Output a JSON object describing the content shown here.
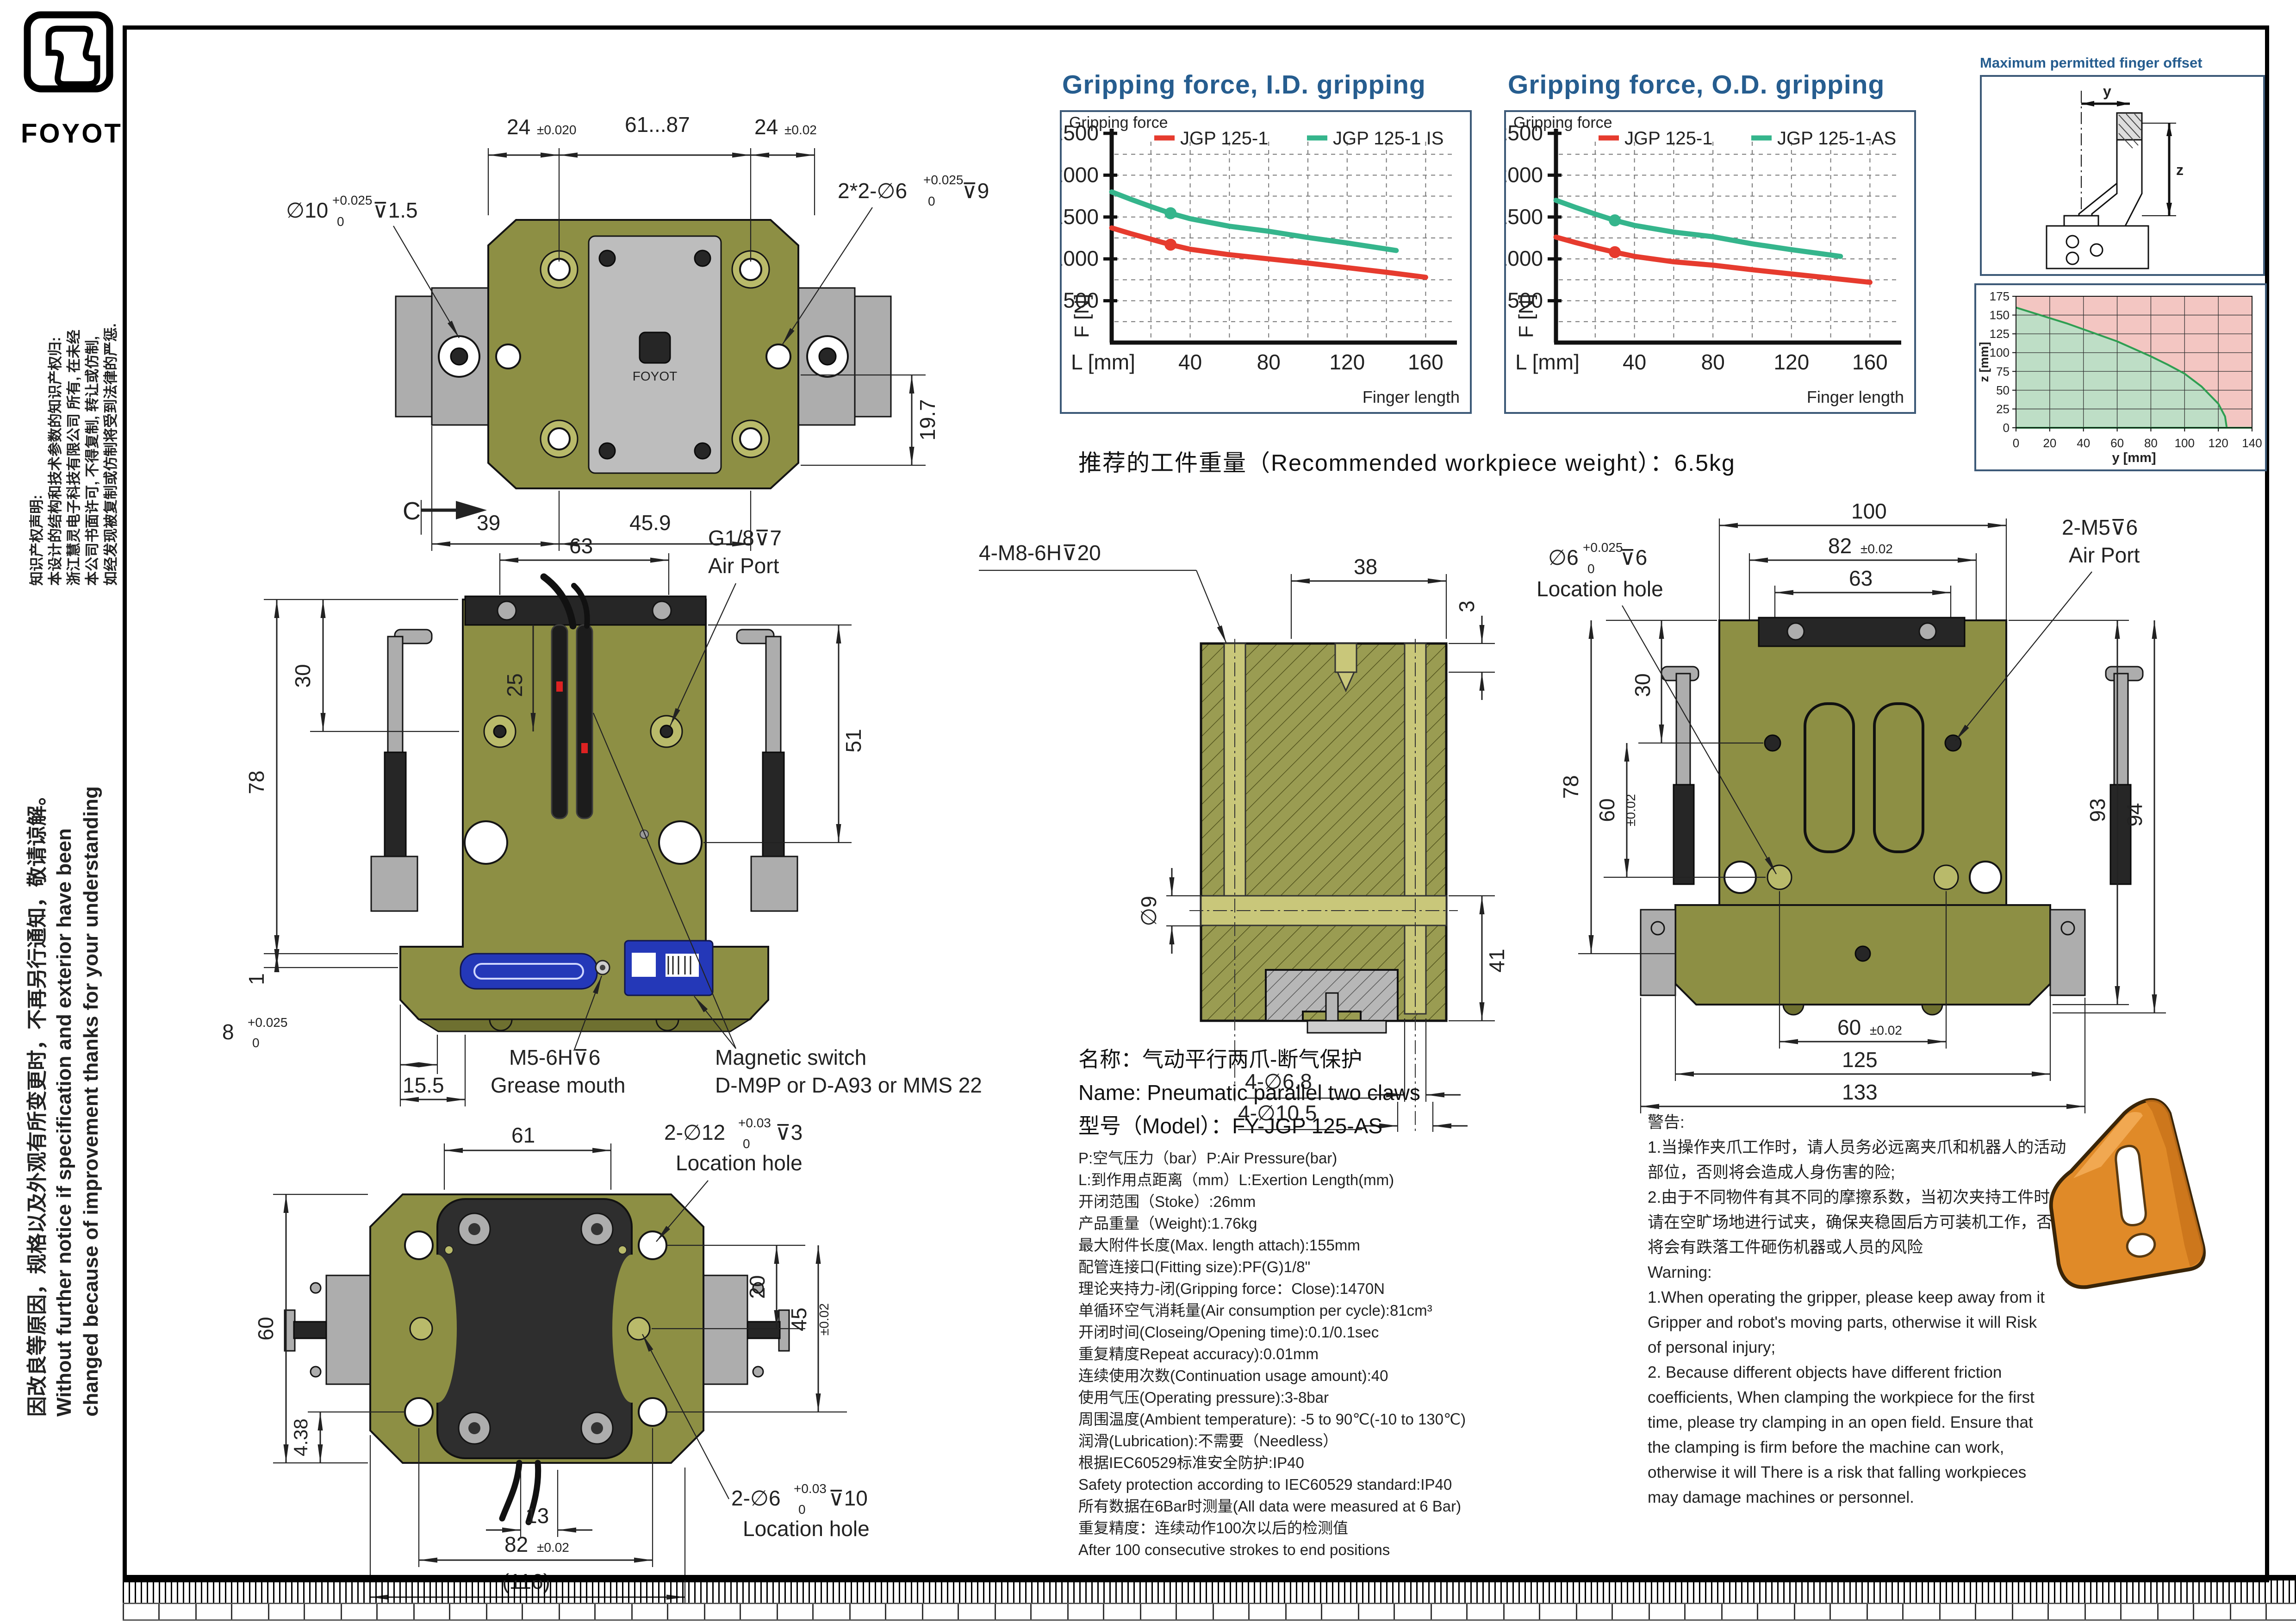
{
  "brand": {
    "name": "FOYOT"
  },
  "left_margin": {
    "ip_lines": [
      "知识产权声明:",
      "本设计的结构和技术参数的知识产权归:",
      "浙江慧灵电子科技有限公司 所有, 在未经",
      "本公司书面许可, 不得复制, 转让或仿制,",
      "如经发现被复制或仿制将受到法律的严惩."
    ],
    "change_lines": [
      "因改良等原因，规格以及外观有所变更时，不再另行通知，敬请谅解。",
      "Without further  notice if specification and exterior have been",
      "changed because of improvement thanks for your understanding"
    ]
  },
  "headings": {
    "id_chart": "Gripping force, I.D. gripping",
    "od_chart": "Gripping force, O.D. gripping",
    "offset": "Maximum permitted finger offset",
    "recommended": "推荐的工件重量（Recommended workpiece weight）：6.5kg"
  },
  "chart_labels": {
    "gripping_force": "Gripping force",
    "f_axis": "F [N]",
    "l_axis": "L [mm]",
    "finger_length": "Finger length",
    "offset_y": "y",
    "offset_z": "z"
  },
  "chart_data": [
    {
      "type": "line",
      "title": "Gripping force, I.D. gripping",
      "xlabel": "L [mm]",
      "ylabel": "F [N]",
      "corner_label": "Finger length",
      "xlim": [
        0,
        175
      ],
      "ylim": [
        0,
        2500
      ],
      "xticks": [
        40,
        80,
        120,
        160
      ],
      "yticks": [
        500,
        1000,
        1500,
        2000,
        2500
      ],
      "xgrid_step": 20,
      "ygrid_step": 250,
      "grid": "dashed",
      "legend_position": "top",
      "series": [
        {
          "name": "JGP 125-1",
          "color": "#e63b2e",
          "x": [
            0,
            10,
            20,
            30,
            40,
            60,
            80,
            100,
            120,
            140,
            160
          ],
          "y": [
            1370,
            1300,
            1235,
            1170,
            1115,
            1050,
            1000,
            950,
            895,
            840,
            780
          ],
          "marker_at": [
            30,
            1170
          ]
        },
        {
          "name": "JGP 125-1 IS",
          "color": "#35b58c",
          "x": [
            0,
            10,
            20,
            30,
            40,
            60,
            80,
            100,
            120,
            145
          ],
          "y": [
            1800,
            1710,
            1625,
            1545,
            1480,
            1390,
            1330,
            1255,
            1190,
            1100
          ],
          "marker_at": [
            30,
            1545
          ]
        }
      ]
    },
    {
      "type": "line",
      "title": "Gripping force, O.D. gripping",
      "xlabel": "L [mm]",
      "ylabel": "F [N]",
      "corner_label": "Finger length",
      "xlim": [
        0,
        175
      ],
      "ylim": [
        0,
        2500
      ],
      "xticks": [
        40,
        80,
        120,
        160
      ],
      "yticks": [
        500,
        1000,
        1500,
        2000,
        2500
      ],
      "xgrid_step": 20,
      "ygrid_step": 250,
      "grid": "dashed",
      "legend_position": "top",
      "series": [
        {
          "name": "JGP 125-1",
          "color": "#e63b2e",
          "x": [
            0,
            10,
            20,
            30,
            40,
            60,
            80,
            100,
            120,
            140,
            160
          ],
          "y": [
            1260,
            1195,
            1135,
            1080,
            1030,
            965,
            925,
            870,
            820,
            770,
            720
          ],
          "marker_at": [
            30,
            1080
          ]
        },
        {
          "name": "JGP 125-1-AS",
          "color": "#35b58c",
          "x": [
            0,
            10,
            20,
            30,
            40,
            60,
            80,
            100,
            120,
            145
          ],
          "y": [
            1700,
            1615,
            1535,
            1460,
            1400,
            1320,
            1265,
            1180,
            1110,
            1030
          ],
          "marker_at": [
            30,
            1460
          ]
        }
      ]
    },
    {
      "type": "area",
      "title": "Maximum permitted finger offset",
      "xlabel": "y [mm]",
      "ylabel": "z [mm]",
      "xlim": [
        0,
        140
      ],
      "ylim": [
        0,
        175
      ],
      "xticks": [
        0,
        20,
        40,
        60,
        80,
        100,
        120,
        140
      ],
      "yticks": [
        0,
        25,
        50,
        75,
        100,
        125,
        150,
        175
      ],
      "grid": "solid",
      "boundary_x": [
        0,
        10,
        20,
        30,
        40,
        50,
        60,
        70,
        80,
        90,
        100,
        110,
        120,
        124,
        125
      ],
      "boundary_y": [
        160,
        153,
        146,
        139,
        131,
        123,
        115,
        105,
        95,
        84,
        72,
        55,
        32,
        15,
        0
      ],
      "safe_color": "#bedec6",
      "unsafe_color": "#f3c6c2",
      "line_color": "#2f9e52"
    }
  ],
  "views": {
    "top": {
      "d24l": "24",
      "t24l": "±0.020",
      "d6187": "61...87",
      "d24r": "24",
      "t24r": "±0.02",
      "holeL": "∅10",
      "holeLt": "+0.025",
      "holeLb": "0",
      "holeLs": "⊽1.5",
      "holeR": "2*2-∅6",
      "holeRt": "+0.025",
      "holeRb": "0",
      "holeRs": "⊽9",
      "d197": "19.7",
      "d39": "39",
      "d459": "45.9"
    },
    "front": {
      "c": "C",
      "d63": "63",
      "d25": "25",
      "d30": "30",
      "d78": "78",
      "d51": "51",
      "d1": "1",
      "d8": "8",
      "d8t": "+0.025",
      "d8b": "0",
      "d155": "15.5",
      "air1": "G1/8⊽7",
      "air2": "Air Port",
      "grease1": "M5-6H⊽6",
      "grease2": "Grease mouth",
      "switch1": "Magnetic switch",
      "switch2": "D-M9P or D-A93 or MMS 22"
    },
    "section": {
      "m8": "4-M8-6H⊽20",
      "d38": "38",
      "d3": "3",
      "d9": "∅9",
      "d41": "41",
      "d68": "4-∅6.8",
      "d105": "4-∅10.5"
    },
    "right": {
      "d100": "100",
      "d82": "82",
      "t82": "±0.02",
      "d63": "63",
      "m5a": "2-M5⊽6",
      "m5b": "Air Port",
      "locA": "∅6",
      "locT": "+0.025",
      "locB": "0",
      "locS": "⊽6",
      "locLabel": "Location hole",
      "d30": "30",
      "d60a": "60",
      "t60a": "±0.02",
      "d78": "78",
      "d93": "93",
      "d94": "94",
      "d60b": "60",
      "t60b": "±0.02",
      "d125": "125",
      "d133": "133"
    },
    "bottom": {
      "c": "C",
      "d61": "61",
      "h12": "2-∅12",
      "h12t": "+0.03",
      "h12b": "0",
      "h12s": "⊽3",
      "loc1": "Location hole",
      "d60": "60",
      "d438": "4.38",
      "d20": "20",
      "d45": "45",
      "t45": "±0.02",
      "d13": "13",
      "d82": "82",
      "t82": "±0.02",
      "d116": "(116)",
      "h6": "2-∅6",
      "h6t": "+0.03",
      "h6b": "0",
      "h6s": "⊽10",
      "loc2": "Location hole"
    }
  },
  "name_block": {
    "cn": "名称：气动平行两爪-断气保护",
    "en": "Name: Pneumatic parallel two claws",
    "model": "型号（Model）：FY-JGP 125-AS"
  },
  "spec": {
    "lines": [
      "P:空气压力（bar）P:Air Pressure(bar)",
      "L:到作用点距离（mm）L:Exertion Length(mm)",
      "开闭范围（Stoke）:26mm",
      "产品重量（Weight):1.76kg",
      "最大附件长度(Max. length attach):155mm",
      "配管连接口(Fitting size):PF(G)1/8\"",
      "理论夹持力-闭(Gripping force：Close):1470N",
      "单循环空气消耗量(Air consumption per cycle):81cm³",
      "开闭时间(Closeing/Opening time):0.1/0.1sec",
      "重复精度Repeat accuracy):0.01mm",
      "连续使用次数(Continuation usage amount):40",
      "使用气压(Operating pressure):3-8bar",
      "周围温度(Ambient temperature): -5 to 90℃(-10 to 130℃)",
      "润滑(Lubrication):不需要（Needless）",
      "根据IEC60529标准安全防护:IP40",
      "Safety protection according to IEC60529 standard:IP40",
      "所有数据在6Bar时测量(All data were measured at 6 Bar)",
      "重复精度：连续动作100次以后的检测值",
      "After 100 consecutive strokes to end positions"
    ]
  },
  "warning": {
    "lines": [
      "警告:",
      "1.当操作夹爪工作时，请人员务必远离夹爪和机器人的活动",
      "部位，否则将会造成人身伤害的险;",
      "2.由于不同物件有其不同的摩擦系数，当初次夹持工件时，",
      "请在空旷场地进行试夹，确保夹稳固后方可装机工作，否则",
      "将会有跌落工件砸伤机器或人员的风险",
      "Warning:",
      "1.When operating the gripper, please keep away from it",
      "Gripper and robot's moving parts, otherwise it will Risk",
      "of personal injury;",
      "2. Because different objects have different friction",
      "coefficients, When clamping the workpiece for the first",
      "time, please try clamping in an open field. Ensure that",
      "the clamping is firm before the machine can work,",
      "otherwise it will There is a risk that falling workpieces",
      "may damage machines or personnel."
    ]
  }
}
